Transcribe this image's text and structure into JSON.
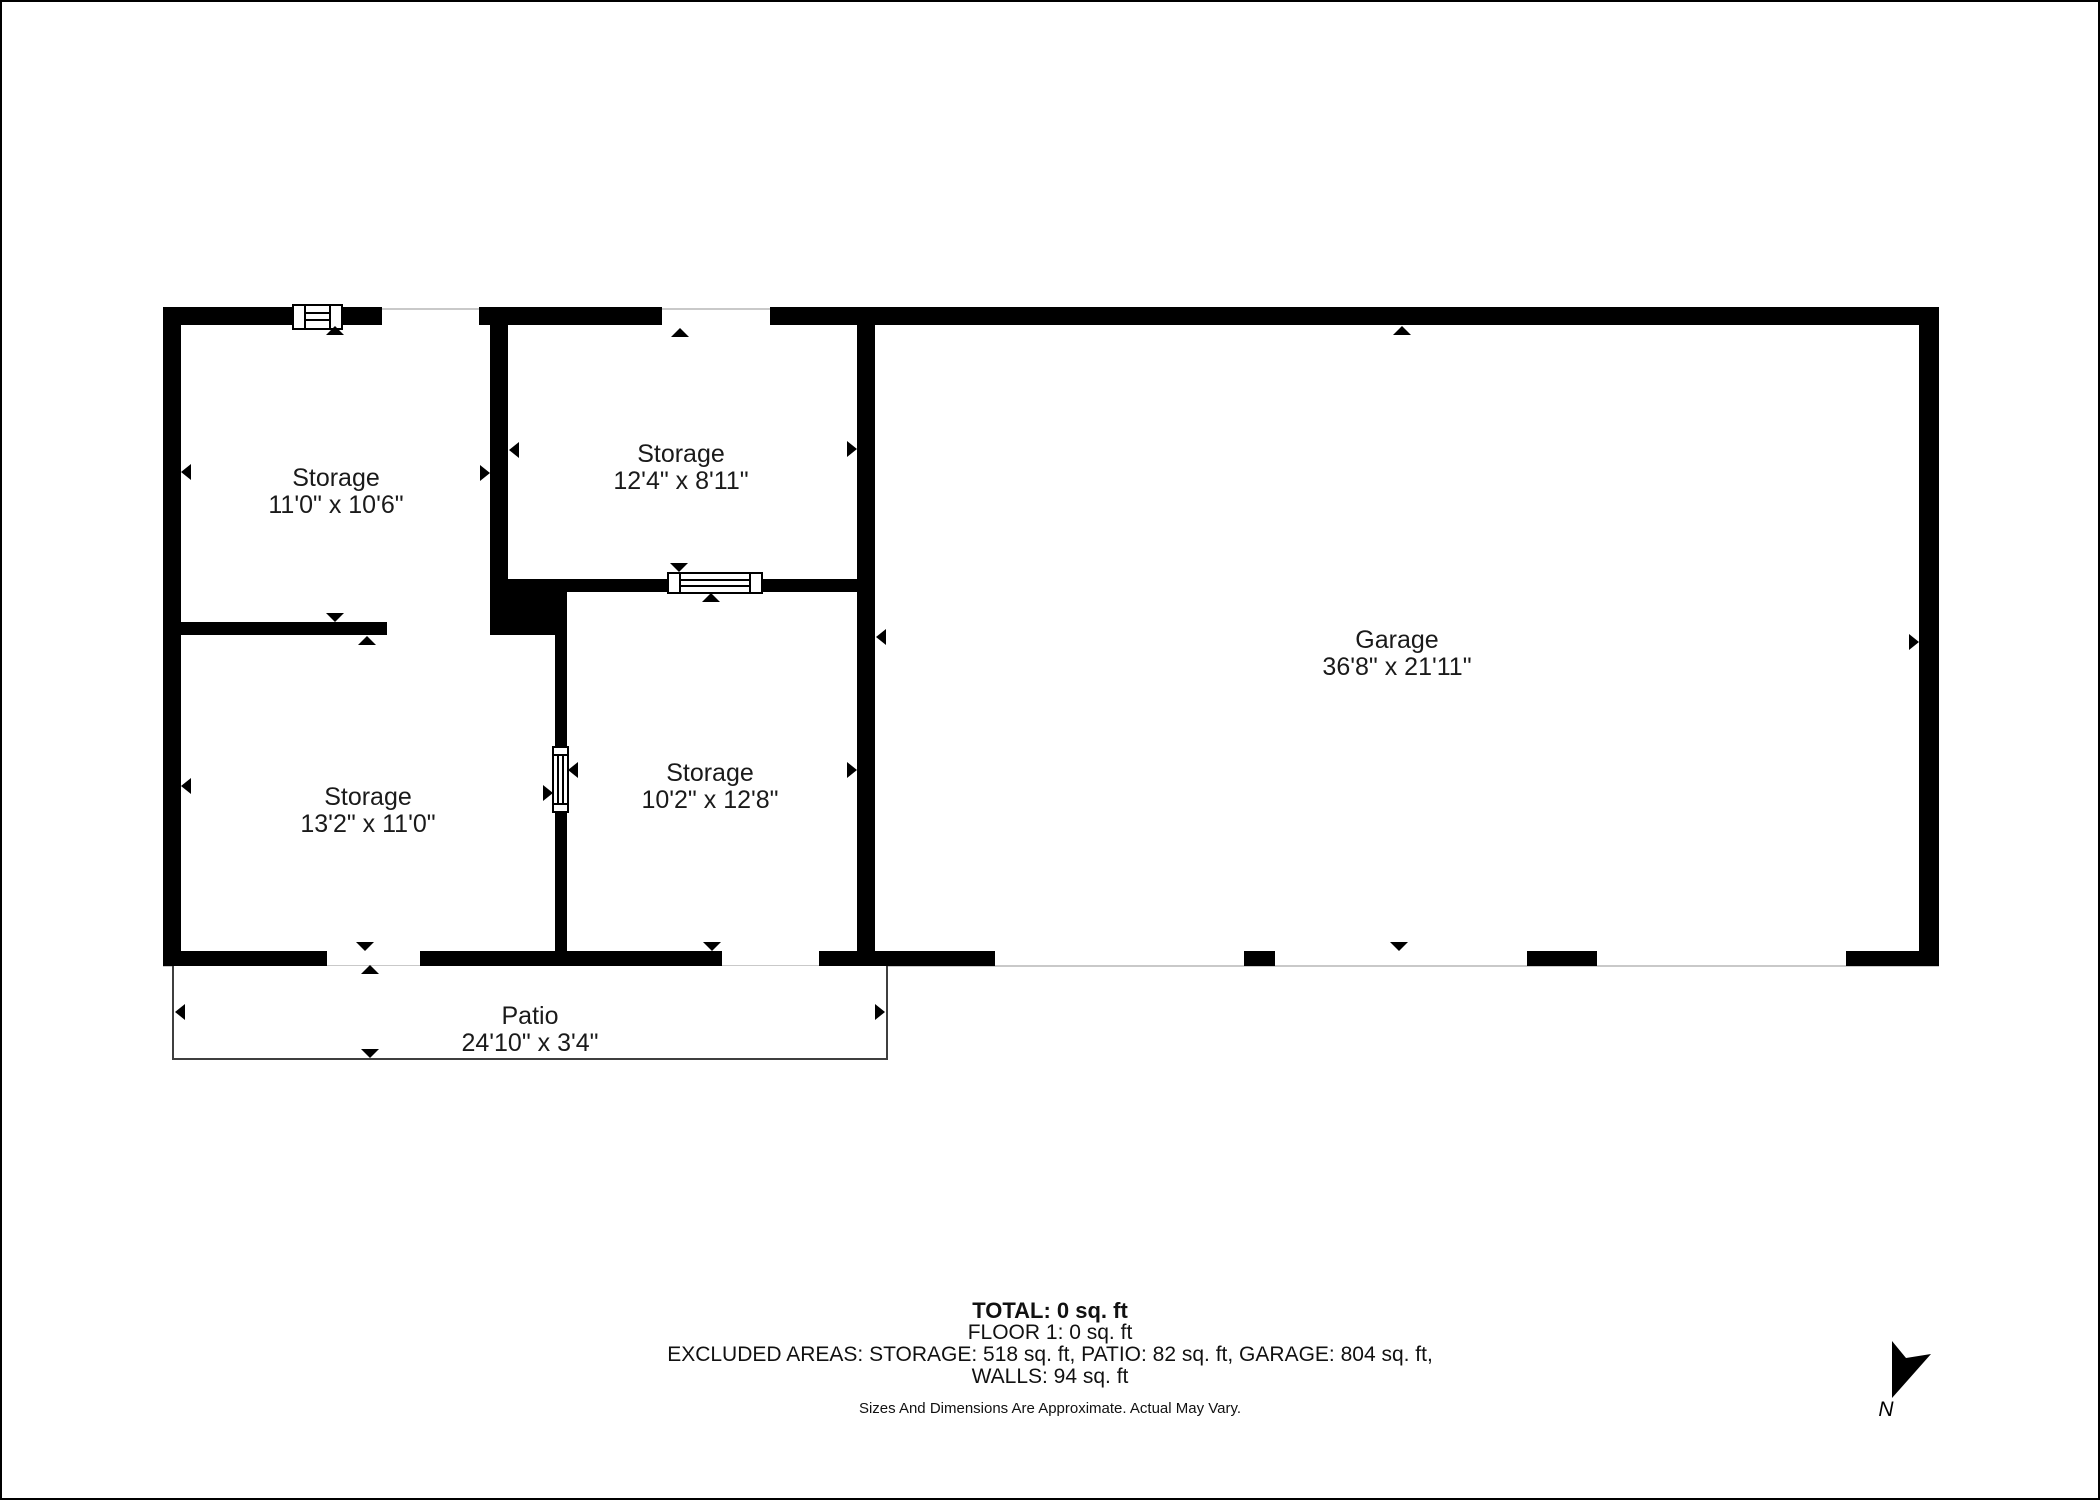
{
  "plan": {
    "type": "floor-plan",
    "floor": "FLOOR 1",
    "wall_color": "#000000",
    "background_color": "#ffffff",
    "outline_color": "#3f3f3f",
    "thin_line_color": "#c9c9c9",
    "text_color": "#1a1a1a"
  },
  "rooms": [
    {
      "name": "Storage",
      "dims": "11'0\" x 10'6\""
    },
    {
      "name": "Storage",
      "dims": "12'4\" x 8'11\""
    },
    {
      "name": "Storage",
      "dims": "13'2\" x 11'0\""
    },
    {
      "name": "Storage",
      "dims": "10'2\" x 12'8\""
    },
    {
      "name": "Garage",
      "dims": "36'8\" x 21'11\""
    },
    {
      "name": "Patio",
      "dims": "24'10\" x 3'4\""
    }
  ],
  "summary": {
    "total": "TOTAL: 0 sq. ft",
    "floor": "FLOOR 1: 0 sq. ft",
    "excluded": "EXCLUDED AREAS: STORAGE: 518 sq. ft, PATIO: 82 sq. ft, GARAGE: 804 sq. ft,",
    "walls": "WALLS: 94 sq. ft",
    "disclaimer": "Sizes And Dimensions Are Approximate. Actual May Vary."
  },
  "excluded_areas": {
    "storage_sqft": 518,
    "patio_sqft": 82,
    "garage_sqft": 804,
    "walls_sqft": 94,
    "total_sqft": 0,
    "floor1_sqft": 0
  },
  "compass": {
    "label": "N"
  }
}
